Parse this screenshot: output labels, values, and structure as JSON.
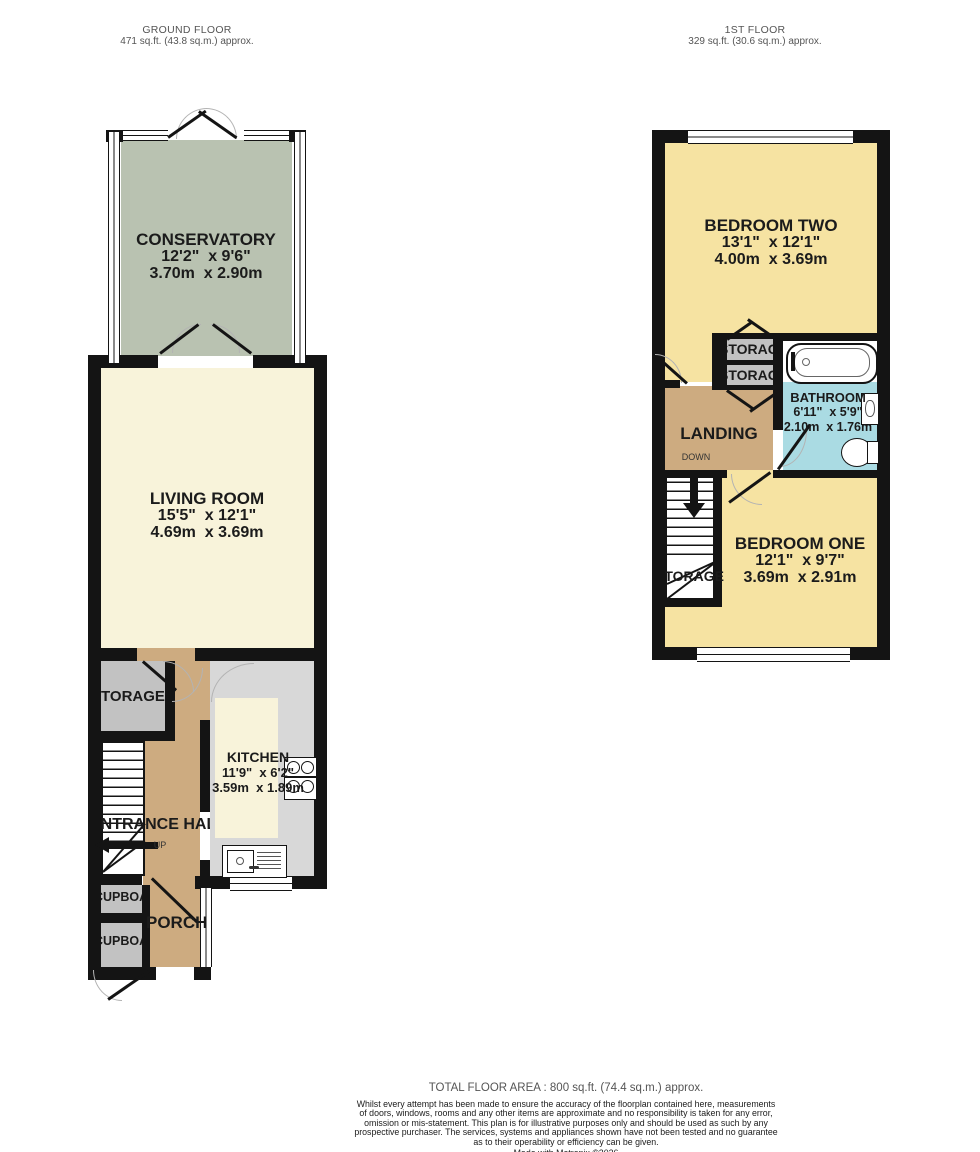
{
  "ground_floor": {
    "title": "GROUND FLOOR",
    "area": "471 sq.ft. (43.8 sq.m.) approx.",
    "rooms": {
      "conservatory": {
        "name": "CONSERVATORY",
        "imperial": "12'2\"  x 9'6\"",
        "metric": "3.70m  x 2.90m"
      },
      "living_room": {
        "name": "LIVING ROOM",
        "imperial": "15'5\"  x 12'1\"",
        "metric": "4.69m  x 3.69m"
      },
      "kitchen": {
        "name": "KITCHEN",
        "imperial": "11'9\"  x 6'2\"",
        "metric": "3.59m  x 1.89m"
      },
      "entrance_hall": {
        "name": "ENTRANCE HALL"
      },
      "porch": {
        "name": "PORCH"
      },
      "storage": {
        "name": "STORAGE"
      },
      "cupboard": {
        "name": "CUPBOARD"
      }
    },
    "stairs_label": "UP"
  },
  "first_floor": {
    "title": "1ST FLOOR",
    "area": "329 sq.ft. (30.6 sq.m.) approx.",
    "rooms": {
      "bedroom_two": {
        "name": "BEDROOM TWO",
        "imperial": "13'1\"  x 12'1\"",
        "metric": "4.00m  x 3.69m"
      },
      "bedroom_one": {
        "name": "BEDROOM ONE",
        "imperial": "12'1\"  x 9'7\"",
        "metric": "3.69m  x 2.91m"
      },
      "bathroom": {
        "name": "BATHROOM",
        "imperial": "6'11\"  x 5'9\"",
        "metric": "2.10m  x 1.76m"
      },
      "landing": {
        "name": "LANDING"
      },
      "storage": {
        "name": "STORAGE"
      }
    },
    "stairs_label": "DOWN"
  },
  "footer": {
    "total_area": "TOTAL FLOOR AREA : 800 sq.ft. (74.4 sq.m.) approx.",
    "disclaimer_lines": [
      "Whilst every attempt has been made to ensure the accuracy of the floorplan contained here, measurements",
      "of doors, windows, rooms and any other items are approximate and no responsibility is taken for any error,",
      "omission or mis-statement. This plan is for illustrative purposes only and should be used as such by any",
      "prospective purchaser. The services, systems and appliances shown have not been tested and no guarantee",
      "as to their operability or efficiency can be given."
    ],
    "credit": "Made with Metropix ©2026"
  },
  "colors": {
    "wall": "#141414",
    "conservatory": "#b9c2b1",
    "living_room": "#f8f3da",
    "bedroom": "#f6e3a2",
    "hallway": "#cdab80",
    "bathroom": "#aadbe3",
    "storage": "#c2c2c2",
    "kitchen_floor": "#d8d8d8"
  }
}
